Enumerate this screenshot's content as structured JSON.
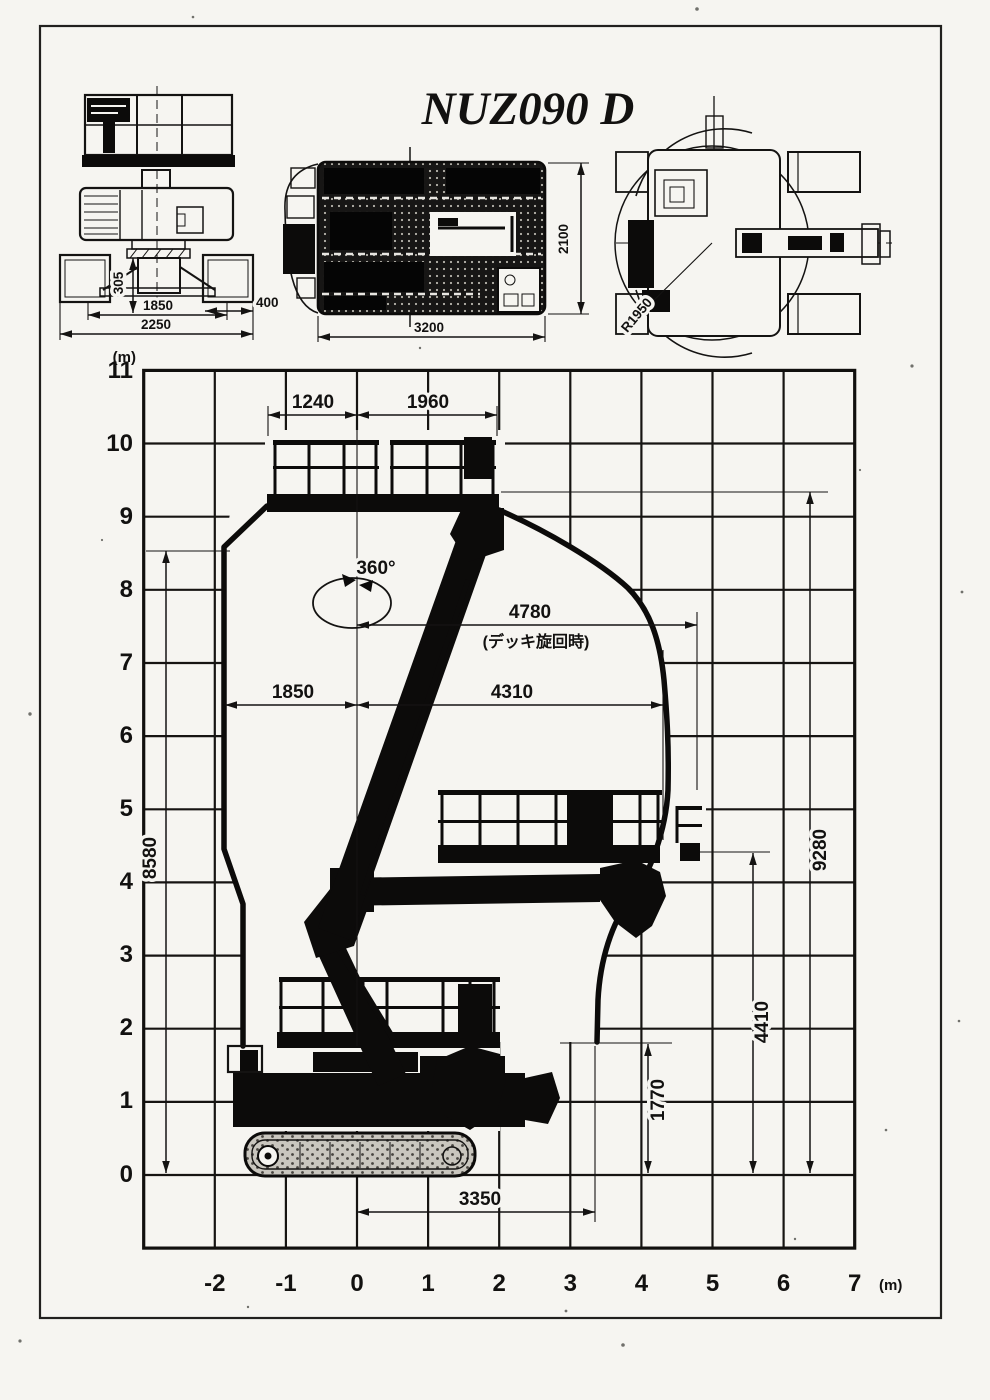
{
  "sheet": {
    "title": "NUZ090 D",
    "unit_label_top": "(m)",
    "unit_label_bottom": "(m)"
  },
  "front_view": {
    "dim_305": "305",
    "dim_1850": "1850",
    "dim_2250": "2250",
    "dim_400": "400"
  },
  "deck_plan_view": {
    "dim_3200": "3200",
    "dim_2100": "2100"
  },
  "swing_plan_view": {
    "dim_r1950": "R1950"
  },
  "chart_data": {
    "type": "line",
    "xlabel": "(m)",
    "ylabel": "(m)",
    "xlim": [
      -3,
      7
    ],
    "ylim": [
      -1,
      11
    ],
    "grid": true,
    "legend": "none",
    "x_ticks": [
      -2,
      -1,
      0,
      1,
      2,
      3,
      4,
      5,
      6,
      7
    ],
    "y_ticks": [
      0,
      1,
      2,
      3,
      4,
      5,
      6,
      7,
      8,
      9,
      10,
      11
    ],
    "series": [
      {
        "name": "work-envelope-outline",
        "points_m": [
          [
            -1.87,
            8.58
          ],
          [
            -1.87,
            4.45
          ],
          [
            -1.62,
            3.7
          ],
          [
            -1.62,
            1.85
          ],
          [
            -1.24,
            9.28
          ],
          [
            1.96,
            9.28
          ],
          [
            2.0,
            9.1
          ],
          [
            3.8,
            8.0
          ],
          [
            4.32,
            6.77
          ],
          [
            4.38,
            5.26
          ],
          [
            3.84,
            3.76
          ],
          [
            3.39,
            1.82
          ]
        ]
      },
      {
        "name": "deck-floor-heights-m",
        "points_m": [
          [
            0,
            9.28
          ],
          [
            0,
            4.41
          ],
          [
            0,
            1.77
          ]
        ]
      }
    ],
    "dims": {
      "d1240": "1240",
      "d1960": "1960",
      "rot360": "360°",
      "d4780": "4780",
      "d4780_note": "(デッキ旋回時)",
      "d1850": "1850",
      "d4310": "4310",
      "d8580": "8580",
      "d9280": "9280",
      "d4410": "4410",
      "d1770": "1770",
      "d3350": "3350"
    }
  }
}
